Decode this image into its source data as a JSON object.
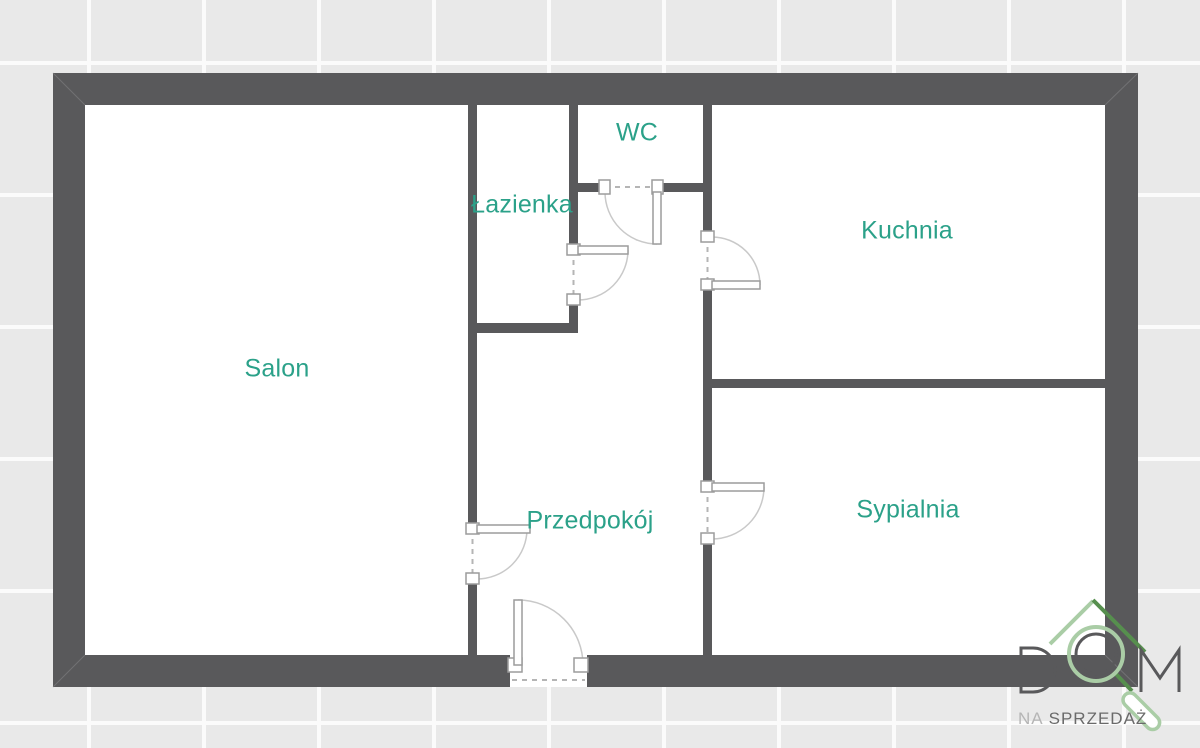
{
  "plan": {
    "type": "apartment-floor-plan",
    "rooms": [
      {
        "id": "salon",
        "label": "Salon"
      },
      {
        "id": "lazienka",
        "label": "Łazienka"
      },
      {
        "id": "wc",
        "label": "WC"
      },
      {
        "id": "kuchnia",
        "label": "Kuchnia"
      },
      {
        "id": "przedpokoj",
        "label": "Przedpokój"
      },
      {
        "id": "sypialnia",
        "label": "Sypialnia"
      }
    ]
  },
  "logo": {
    "wordmark": "DOM",
    "tagline_prefix": "NA",
    "tagline": "SPRZEDAŻ"
  },
  "colors": {
    "wall": "#59595b",
    "room_label": "#2ba189",
    "tile": "#e9e9e9",
    "grout": "#fbfbfb",
    "logo_green_light": "#aacda6",
    "logo_green_dark": "#568f4e",
    "logo_gray_dark": "#59595b",
    "logo_gray_light": "#b5b5b5"
  }
}
